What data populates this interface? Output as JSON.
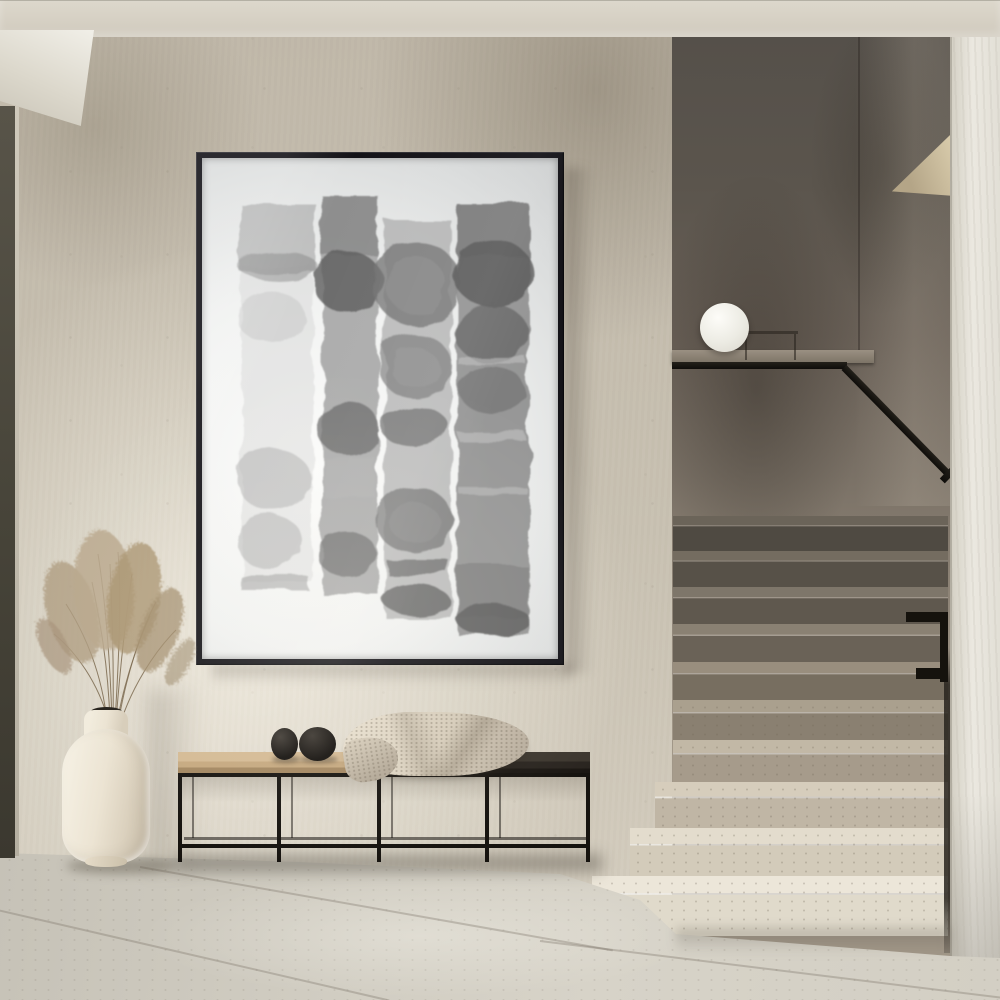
{
  "meta": {
    "title": "Minimalist interior hallway — framed abstract watercolor, bench, vase and terrazzo staircase",
    "style": "beige limewash plaster interior, photographic render, no visible text"
  },
  "colors": {
    "wall": "#c3bbac",
    "wallLight": "#ece6d8",
    "wallDark": "#9a9081",
    "ceiling": "#d8d3c7",
    "soffit": "#efede6",
    "doorFrame": "#4a4740",
    "frame": "#141318",
    "paper": "#f2f3f2",
    "artInk": "#6e6e6e",
    "stairwellDark": "#55504a",
    "stairwellMid": "#7f766b",
    "stepDark": "#4f4a42",
    "stepLight": "#e0dacb",
    "railing": "#0f0d0a",
    "lamp": "#d9d6cc",
    "pillar": "#ebe8e0",
    "floor": "#d7d3c8",
    "grout": "#8e887c",
    "vase": "#ebe3d2",
    "grass": "#b09d81",
    "benchWood": "#c5a87f",
    "benchDark": "#2a2520",
    "benchMetal": "#16130f",
    "pebble": "#1d1915",
    "throw": "#d5cbb9"
  },
  "objects": {
    "artwork": {
      "label": "Framed abstract watercolor — four vertical grey ink strips with circular blooms, thin black frame"
    },
    "vase": {
      "label": "Cream ceramic vase with dried pampas grass"
    },
    "grass": {
      "label": "Dried pampas grass plumes"
    },
    "bench": {
      "label": "Black metal bench, wood and dark seat"
    },
    "pebbles": {
      "label": "Two black stone decor objects on bench"
    },
    "throw": {
      "label": "Beige knit throw blanket draped on bench"
    },
    "lamp": {
      "label": "White sphere lamp on stair half-wall ledge"
    },
    "staircase": {
      "label": "Terrazzo staircase from shadow to light with black handrail"
    },
    "handrail": {
      "label": "Black metal handrail descending the stairs"
    },
    "pillar": {
      "label": "Light plaster pillar at right edge"
    },
    "floor": {
      "label": "Large-format greige stone tile floor"
    },
    "wall": {
      "label": "Warm beige limewash plaster wall"
    },
    "ceiling": {
      "label": "Light plaster ceiling band"
    },
    "doorframe": {
      "label": "Dark door/window frame at left edge"
    }
  },
  "artwork_strips": [
    {
      "name": "strip-1",
      "tone": "pale grey, faint square wash top, two soft round blooms lower, base bar"
    },
    {
      "name": "strip-2",
      "tone": "medium grey column, dark blooms at top, middle and bottom"
    },
    {
      "name": "strip-3",
      "tone": "light-mid grey column with four ringed circular blooms"
    },
    {
      "name": "strip-4",
      "tone": "widest dark grey column, two blooms, light banding, dark fringed base"
    }
  ]
}
